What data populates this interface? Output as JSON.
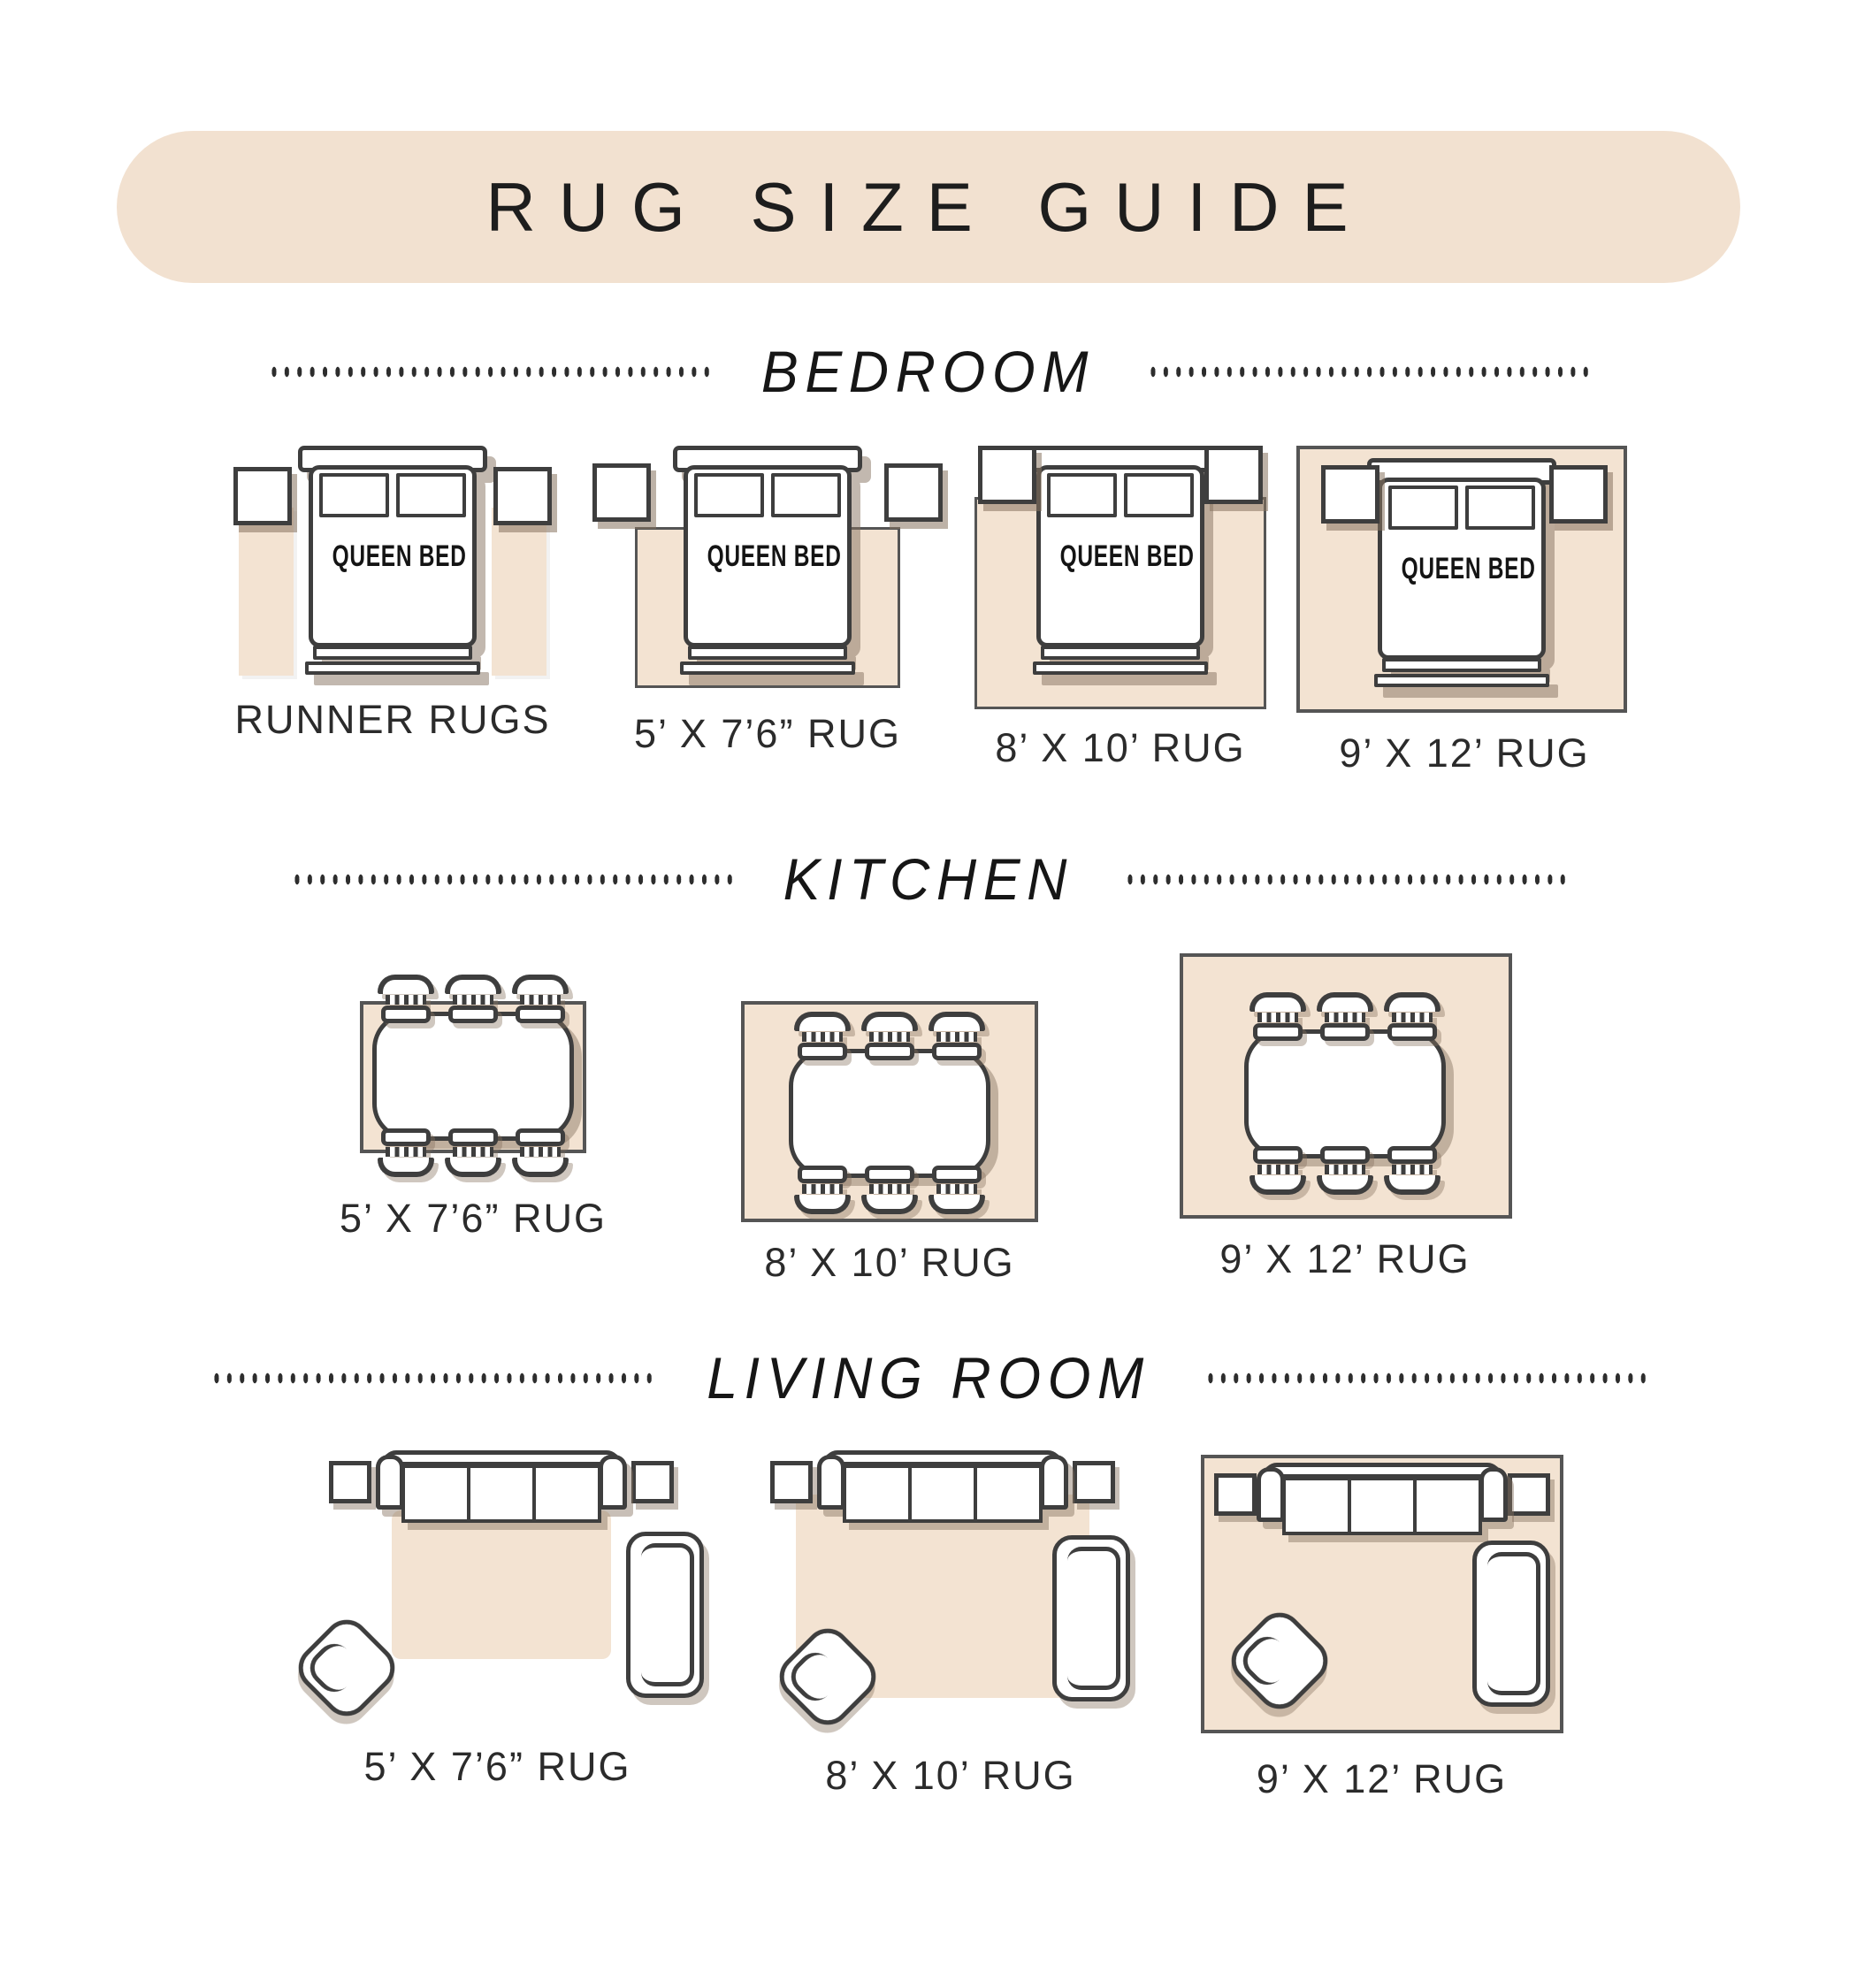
{
  "title": "RUG SIZE GUIDE",
  "bed_label": "QUEEN BED",
  "sections": {
    "bedroom": {
      "heading": "BEDROOM",
      "captions": [
        "RUNNER RUGS",
        "5’ X 7’6” RUG",
        "8’ X 10’ RUG",
        "9’ X 12’ RUG"
      ]
    },
    "kitchen": {
      "heading": "KITCHEN",
      "captions": [
        "5’ X 7’6” RUG",
        "8’ X 10’ RUG",
        "9’ X 12’ RUG"
      ]
    },
    "living": {
      "heading": "LIVING ROOM",
      "captions": [
        "5’ X 7’6” RUG",
        "8’ X 10’ RUG",
        "9’ X 12’ RUG"
      ]
    }
  },
  "colors": {
    "banner": "#f2e1d0",
    "rug": "#f3e3d2",
    "outline": "#3e3e3e",
    "rug_border": "#555555",
    "shadow": "#86725f",
    "text": "#2b2b2b"
  }
}
